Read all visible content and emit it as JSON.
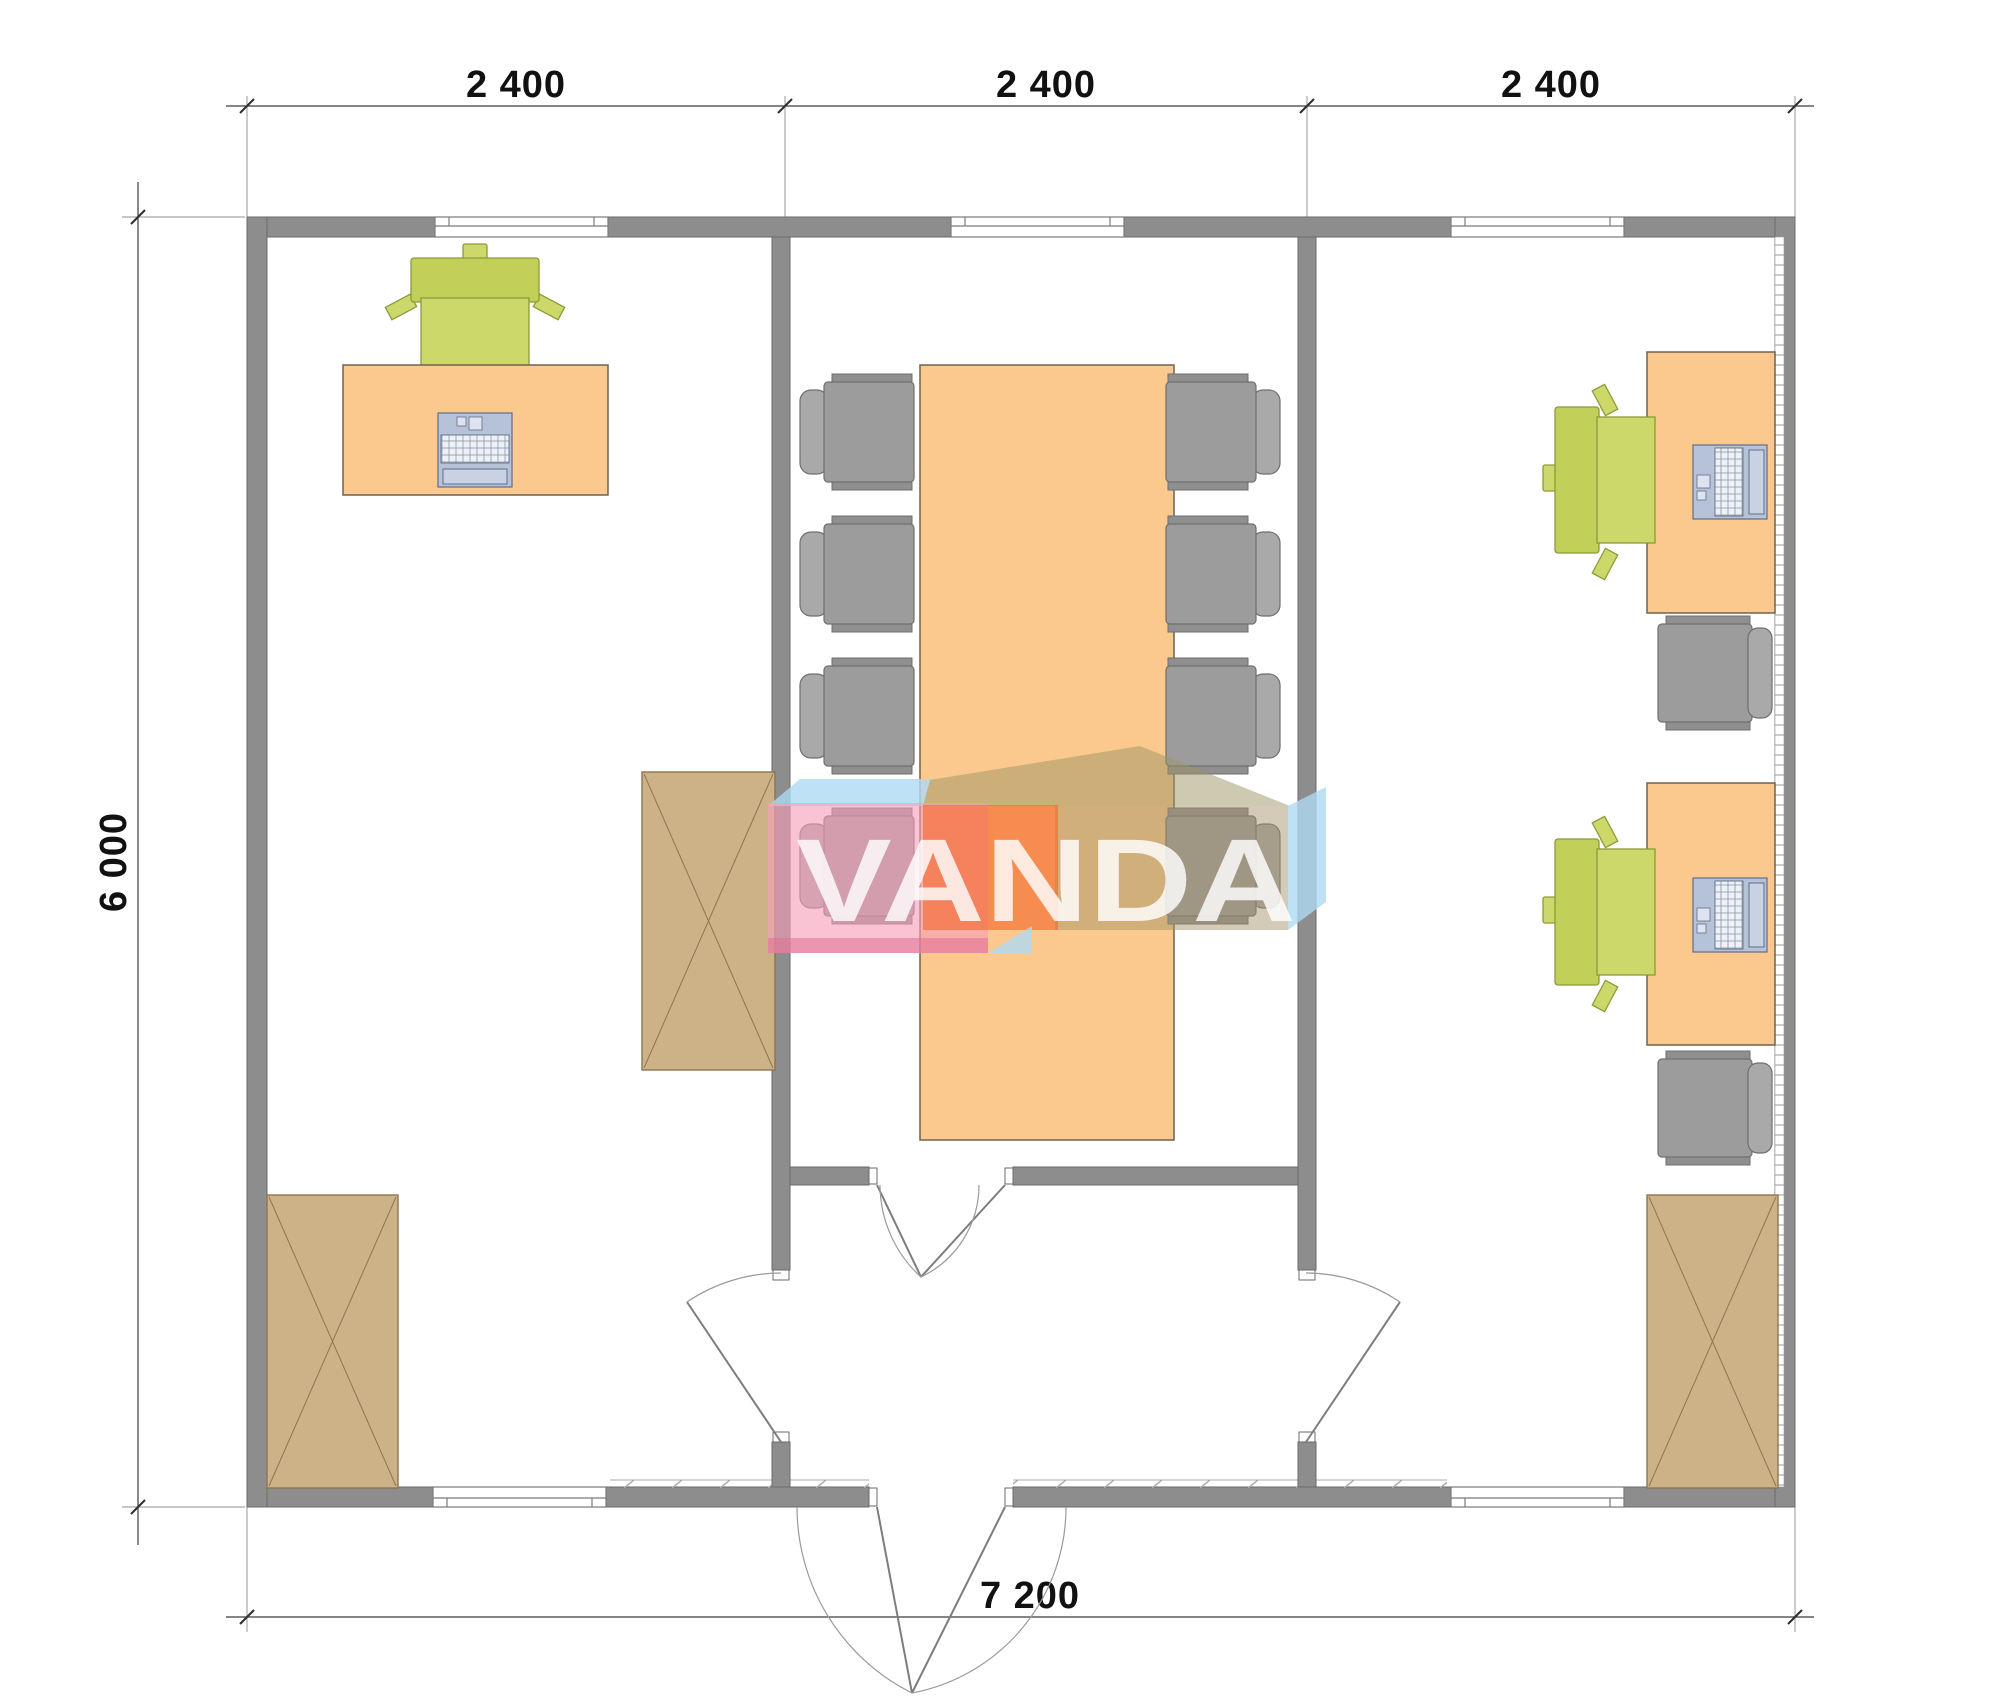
{
  "drawing": {
    "type": "office-floor-plan-top-view",
    "dimensions": {
      "top_segments": [
        "2 400",
        "2 400",
        "2 400"
      ],
      "left_total": "6 000",
      "bottom_total": "7 200"
    },
    "watermark": {
      "text": "VANDA"
    },
    "rooms": [
      {
        "id": "left-office",
        "furniture": [
          "office-desk",
          "green-office-chair",
          "laptop",
          "tall-cabinet",
          "corner-wardrobe"
        ]
      },
      {
        "id": "meeting-room",
        "furniture": [
          "conference-table",
          "gray-chair x8"
        ]
      },
      {
        "id": "right-office",
        "furniture": [
          "office-desk x2",
          "green-office-chair x2",
          "laptop x2",
          "gray-side-chair x2",
          "wardrobe"
        ]
      },
      {
        "id": "entrance-vestibule",
        "furniture": [
          "interior-double-door",
          "exterior-double-door",
          "room-door x2"
        ]
      }
    ],
    "windows_count": 5
  },
  "colors": {
    "wall": "#8d8d8d",
    "desk": "#fbc98d",
    "green": "#ccd96a",
    "cgray": "#9c9c9c",
    "tan": "#cdb287",
    "wm-pink": "rgba(246,158,185,0.62)",
    "wm-orange": "rgba(243,104,45,0.62)",
    "wm-tan": "rgba(158,147,99,0.50)",
    "wm-blue": "rgba(175,217,242,0.80)",
    "wm-text": "rgba(255,255,255,0.82)"
  }
}
